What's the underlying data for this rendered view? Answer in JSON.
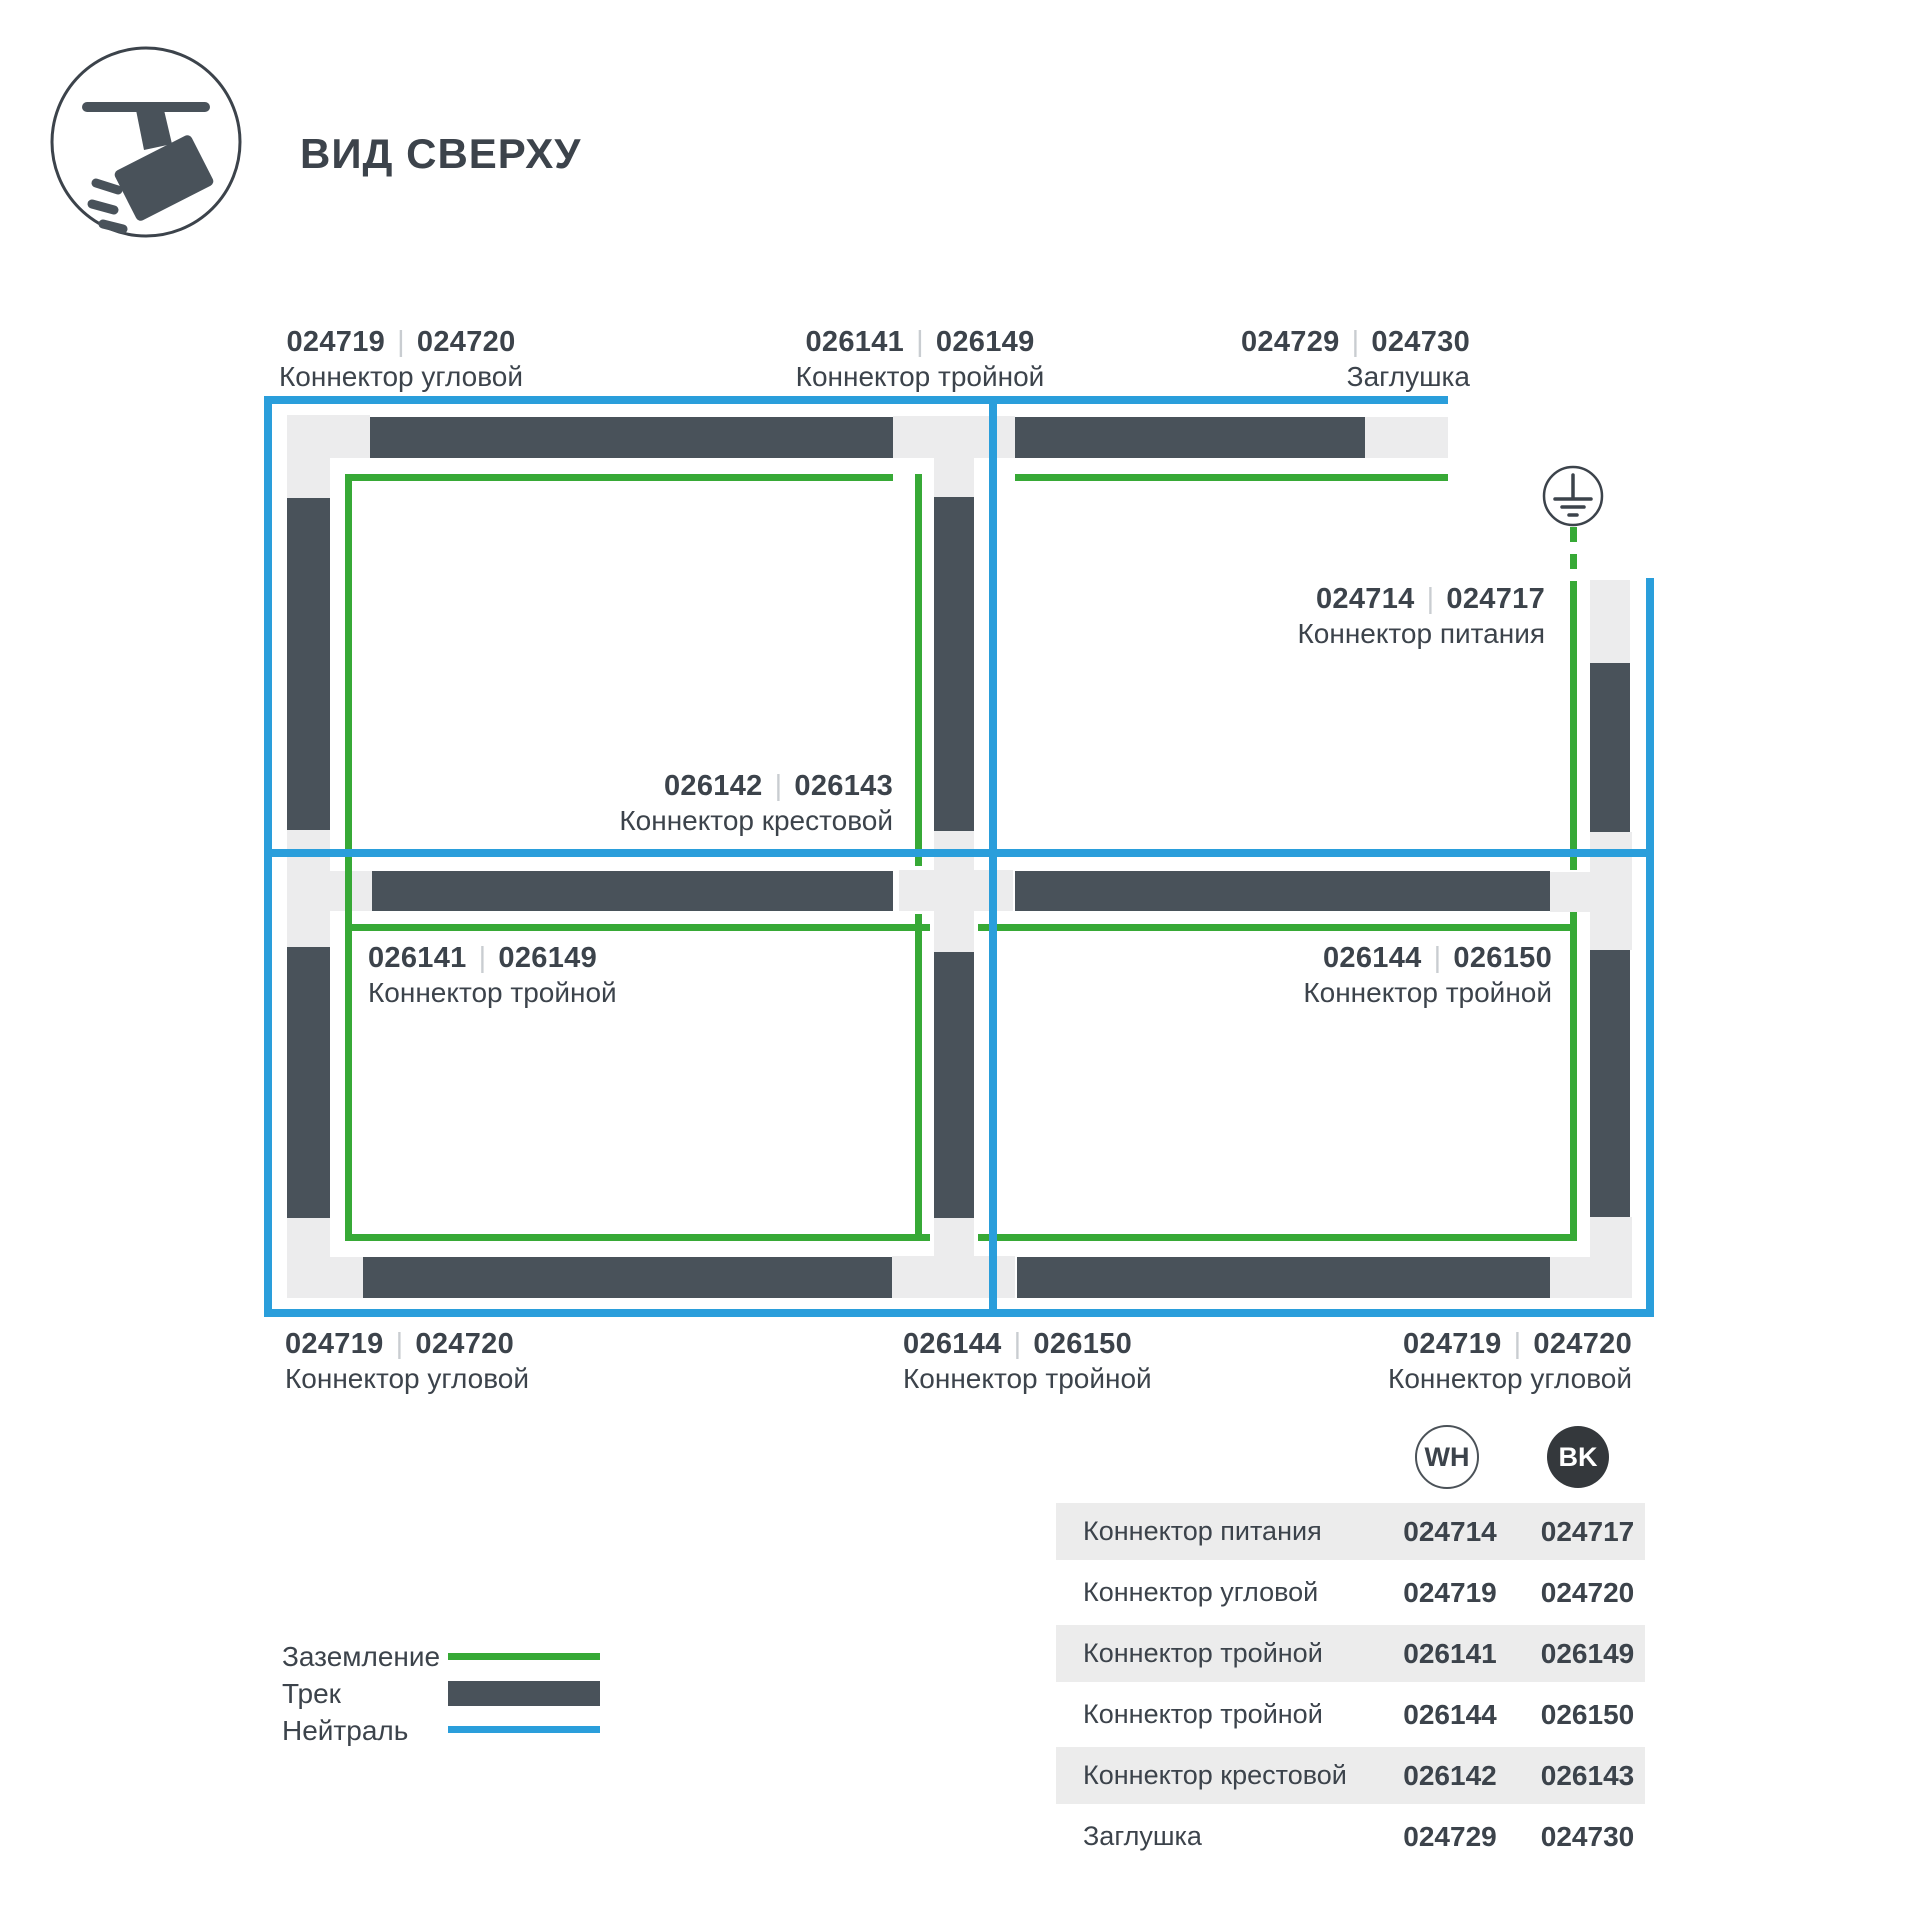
{
  "page": {
    "title": "ВИД СВЕРХУ"
  },
  "diagram": {
    "separator": "|",
    "colors": {
      "track": "#49525a",
      "connector": "#ececed",
      "ground": "#37a936",
      "neutral": "#2a9edb"
    },
    "labels": {
      "corner_tl": {
        "code_wh": "024719",
        "code_bk": "024720",
        "name": "Коннектор угловой"
      },
      "triple_top": {
        "code_wh": "026141",
        "code_bk": "026149",
        "name": "Коннектор тройной"
      },
      "endcap_top": {
        "code_wh": "024729",
        "code_bk": "024730",
        "name": "Заглушка"
      },
      "power": {
        "code_wh": "024714",
        "code_bk": "024717",
        "name": "Коннектор питания"
      },
      "cross": {
        "code_wh": "026142",
        "code_bk": "026143",
        "name": "Коннектор крестовой"
      },
      "triple_left": {
        "code_wh": "026141",
        "code_bk": "026149",
        "name": "Коннектор тройной"
      },
      "triple_right": {
        "code_wh": "026144",
        "code_bk": "026150",
        "name": "Коннектор тройной"
      },
      "corner_bl": {
        "code_wh": "024719",
        "code_bk": "024720",
        "name": "Коннектор угловой"
      },
      "triple_bottom": {
        "code_wh": "026144",
        "code_bk": "026150",
        "name": "Коннектор тройной"
      },
      "corner_br": {
        "code_wh": "024719",
        "code_bk": "024720",
        "name": "Коннектор угловой"
      }
    }
  },
  "legend": {
    "items": [
      {
        "label": "Заземление",
        "type": "ground-line"
      },
      {
        "label": "Трек",
        "type": "track-bar"
      },
      {
        "label": "Нейтраль",
        "type": "neutral-line"
      }
    ]
  },
  "table": {
    "columns": [
      {
        "id": "wh",
        "label": "WH"
      },
      {
        "id": "bk",
        "label": "BK"
      }
    ],
    "rows": [
      {
        "name": "Коннектор питания",
        "wh": "024714",
        "bk": "024717"
      },
      {
        "name": "Коннектор угловой",
        "wh": "024719",
        "bk": "024720"
      },
      {
        "name": "Коннектор тройной",
        "wh": "026141",
        "bk": "026149"
      },
      {
        "name": "Коннектор тройной",
        "wh": "026144",
        "bk": "026150"
      },
      {
        "name": "Коннектор крестовой",
        "wh": "026142",
        "bk": "026143"
      },
      {
        "name": "Заглушка",
        "wh": "024729",
        "bk": "024730"
      }
    ]
  }
}
